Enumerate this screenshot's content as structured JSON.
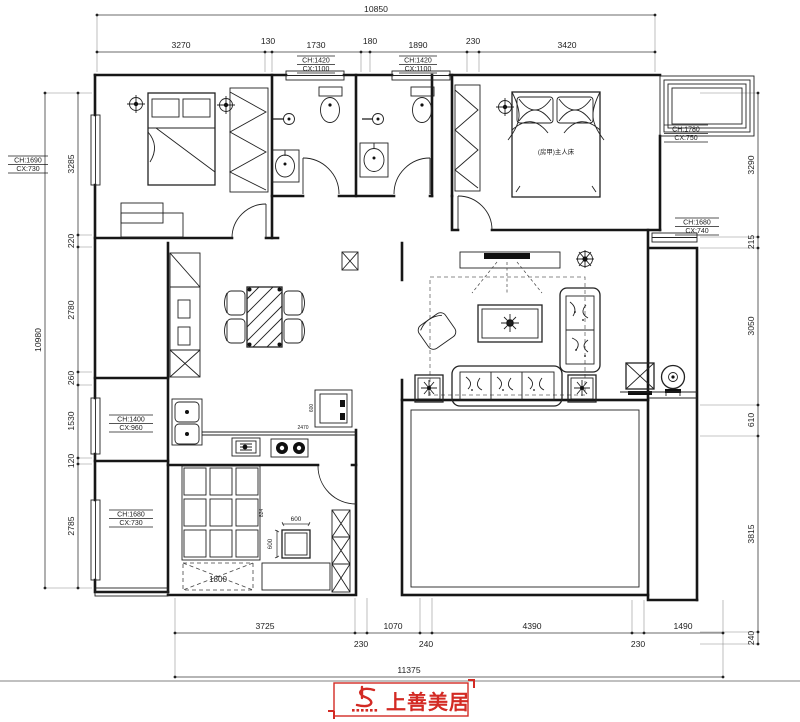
{
  "plan": {
    "logo": {
      "brand": "上善美居"
    },
    "labels": {
      "master_bed": "(房甲)主人床"
    },
    "dims": {
      "top": {
        "overall": "10850",
        "segments": [
          "3270",
          "130",
          "1730",
          "180",
          "1890",
          "230",
          "3420"
        ]
      },
      "left": {
        "overall": "10980",
        "segments": [
          "3285",
          "220",
          "2780",
          "260",
          "1530",
          "120",
          "2785"
        ]
      },
      "right": {
        "segments": [
          "3290",
          "215",
          "3050",
          "610",
          "3815",
          "240"
        ]
      },
      "bottom": {
        "overall": "11375",
        "segments": [
          "3725",
          "230",
          "1070",
          "240",
          "4390",
          "230",
          "1490"
        ]
      },
      "inner": {
        "wardrobe": "1800",
        "square_w": "600",
        "square_h": "600",
        "counter": "2470",
        "tile": "824",
        "appliance": "600"
      }
    },
    "window_tags": {
      "bath1": {
        "ch": "CH:1420",
        "cx": "CX:1100"
      },
      "bath2": {
        "ch": "CH:1420",
        "cx": "CX:1100"
      },
      "left_top": {
        "ch": "CH:1690",
        "cx": "CX:730"
      },
      "master": {
        "ch": "CH:1780",
        "cx": "CX:750"
      },
      "right_mid": {
        "ch": "CH:1680",
        "cx": "CX:740"
      },
      "left_mid": {
        "ch": "CH:1400",
        "cx": "CX:960"
      },
      "left_bottom": {
        "ch": "CH:1680",
        "cx": "CX:730"
      }
    }
  }
}
